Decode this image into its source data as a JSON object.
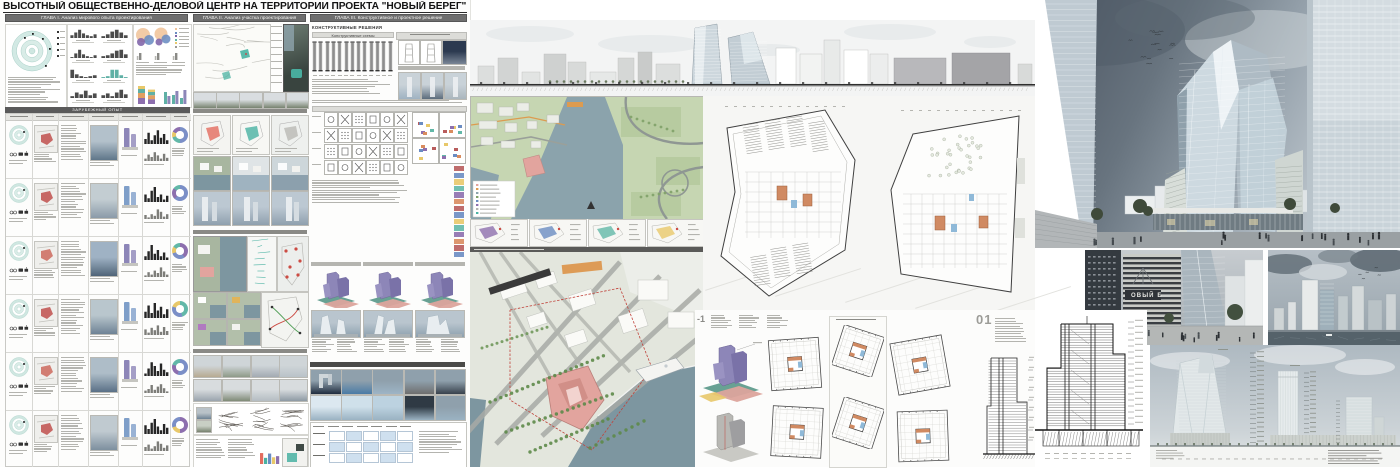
{
  "board": {
    "title": "ВЫСОТНЫЙ ОБЩЕСТВЕННО-ДЕЛОВОЙ ЦЕНТР НА ТЕРРИТОРИИ ПРОЕКТА \"НОВЫЙ БЕРЕГ\"",
    "chapters": [
      {
        "label": "ГЛАВА I. Анализ мирового опыта проектирования"
      },
      {
        "label": "ГЛАВА II. Анализ участка проектирования"
      },
      {
        "label": "ГЛАВА III. Конструктивное и проектное решение"
      }
    ]
  },
  "chapter1": {
    "case_table_title": "ЗАРУБЕЖНЫЙ ОПЫТ"
  },
  "chapter3": {
    "section_title": "КОНСТРУКТИВНЫЕ РЕШЕНИЯ",
    "schemes_title": "Конструктивные схемы"
  },
  "drawings": {
    "underground_level_label": "-1",
    "first_level_label": "01"
  },
  "renders": {
    "building_sign": "ОВЫЙ Б"
  },
  "palette": {
    "header_bar": "#6e6e6e",
    "teal": "#49b2a2",
    "site_pink": "#e2a49e",
    "massing_purple": "#8d86b8",
    "accent_orange": "#d98c5f",
    "water": "#7d96a0",
    "greenery": "#c6d6b2",
    "donut_blue": "#7b8fc7",
    "donut_purple": "#8d6fae",
    "donut_yellow": "#e8c86a",
    "donut_teal": "#62b8a8"
  },
  "figures": {
    "histograms": [
      [
        3,
        6,
        9,
        5,
        3,
        2,
        4
      ],
      [
        2,
        4,
        7,
        9,
        6,
        3
      ],
      [
        1,
        5,
        9,
        4,
        2,
        1,
        3
      ],
      [
        2,
        3,
        5,
        8,
        9,
        4
      ],
      [
        9,
        4,
        2,
        1,
        2,
        3
      ],
      [
        1,
        2,
        9,
        9,
        3,
        1
      ],
      [
        2,
        6,
        4,
        8,
        3,
        5
      ],
      [
        3,
        5,
        2,
        6,
        9,
        4
      ]
    ],
    "bubble_legend_colors": [
      "#f0c49a",
      "#6a8cc2",
      "#7e63a8",
      "#62b8a8",
      "#e8c86a",
      "#9a9a96"
    ],
    "stacked_segments": [
      [
        "#8d6fae",
        6
      ],
      [
        "#e2a062",
        5
      ],
      [
        "#5fb0a5",
        4
      ],
      [
        "#e8c86a",
        3
      ]
    ],
    "grouped_pairs": [
      [
        12,
        8
      ],
      [
        9,
        13
      ],
      [
        6,
        14
      ]
    ],
    "case_rows": [
      {
        "skyline": [
          4,
          9,
          3,
          7,
          11,
          5,
          8,
          3
        ],
        "donut": [
          [
            "#7b8fc7",
            50
          ],
          [
            "#62b8a8",
            20
          ],
          [
            "#e8c86a",
            12
          ],
          [
            "#8d6fae",
            18
          ]
        ],
        "massing": "#8d86b8",
        "photo_top": "#b3c1cb",
        "photo_bottom": "#5f7689",
        "map_color": "#c0504d"
      },
      {
        "skyline": [
          6,
          3,
          9,
          12,
          4,
          6,
          2,
          5
        ],
        "donut": [
          [
            "#7b8fc7",
            62
          ],
          [
            "#8d6fae",
            23
          ],
          [
            "#62b8a8",
            15
          ]
        ],
        "massing": "#7f9fc9",
        "photo_top": "#c3cdd2",
        "photo_bottom": "#8a9aa8",
        "map_color": "#c0504d"
      },
      {
        "skyline": [
          3,
          7,
          12,
          5,
          8,
          3,
          6,
          2
        ],
        "donut": [
          [
            "#8d6fae",
            40
          ],
          [
            "#7b8fc7",
            30
          ],
          [
            "#e8c86a",
            14
          ],
          [
            "#62b8a8",
            16
          ]
        ],
        "massing": "#8d86b8",
        "photo_top": "#9fb2c4",
        "photo_bottom": "#4f6478",
        "map_color": "#cd6a5e"
      },
      {
        "skyline": [
          5,
          10,
          4,
          12,
          6,
          9,
          3,
          7
        ],
        "donut": [
          [
            "#62b8a8",
            45
          ],
          [
            "#7b8fc7",
            35
          ],
          [
            "#e8c86a",
            20
          ]
        ],
        "massing": "#7f9fc9",
        "photo_top": "#b9c6cd",
        "photo_bottom": "#6e8294",
        "map_color": "#c0504d"
      },
      {
        "skyline": [
          2,
          6,
          11,
          8,
          4,
          10,
          5,
          3
        ],
        "donut": [
          [
            "#7b8fc7",
            55
          ],
          [
            "#8d6fae",
            25
          ],
          [
            "#62b8a8",
            20
          ]
        ],
        "massing": "#8d86b8",
        "photo_top": "#aebdc8",
        "photo_bottom": "#5a7086",
        "map_color": "#cd6a5e"
      },
      {
        "skyline": [
          7,
          4,
          9,
          12,
          6,
          3,
          8,
          5
        ],
        "donut": [
          [
            "#8d6fae",
            50
          ],
          [
            "#e8c86a",
            20
          ],
          [
            "#7b8fc7",
            30
          ]
        ],
        "massing": "#7f9fc9",
        "photo_top": "#c0cad0",
        "photo_bottom": "#7d8f9e",
        "map_color": "#c0504d"
      }
    ],
    "maps_row_colors": [
      "#8d6fae",
      "#6a8cc2",
      "#62b8a8",
      "#e8c86a"
    ],
    "ref_photo_colors_row1": [
      "#1f2c3e",
      "#4a7ba6",
      "#9db4c6",
      "#6e6e6e",
      "#38414c"
    ],
    "ref_photo_colors_row2": [
      "#dce8f0",
      "#cfe0ea",
      "#bcd2e0",
      "#2f3a44",
      "#8fa0ac"
    ],
    "photo_band_colors_row1": [
      "#b7aa92",
      "#8e9a88",
      "#a3aab2",
      "#b9c2c8"
    ],
    "photo_band_colors_row2": [
      "#9aa4ad",
      "#7f8a77",
      "#b4bcc2",
      "#8d99a4"
    ],
    "scheme_column_count": 13,
    "icon_grid": [
      6,
      4
    ],
    "variant_count": 3
  }
}
